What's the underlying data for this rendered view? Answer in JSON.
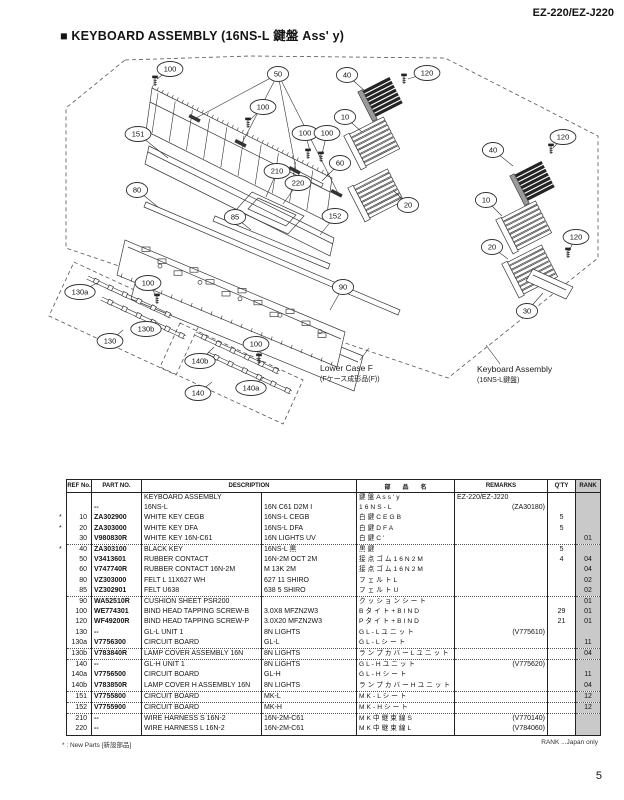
{
  "page": {
    "model": "EZ-220/EZ-J220",
    "title": "■ KEYBOARD ASSEMBLY (16NS-L 鍵盤 Ass' y)",
    "page_number": "5",
    "footnote_left": "* : New Parts [新設部品]",
    "footnote_right": "RANK ...Japan only"
  },
  "diagram": {
    "labels": {
      "lower_case": {
        "en": "Lower Case F",
        "ja": "(Fケース成形品(F))"
      },
      "keyboard_assembly": {
        "en": "Keyboard Assembly",
        "ja": "(16NS-L鍵盤)"
      }
    },
    "callouts": [
      {
        "n": "100",
        "x": 170,
        "y": 69,
        "t": [
          [
            157,
            79
          ]
        ]
      },
      {
        "n": "50",
        "x": 278,
        "y": 74,
        "t": [
          [
            196,
            118
          ],
          [
            242,
            143
          ],
          [
            296,
            170
          ],
          [
            338,
            193
          ]
        ]
      },
      {
        "n": "100",
        "x": 263,
        "y": 107,
        "t": [
          [
            250,
            120
          ]
        ]
      },
      {
        "n": "151",
        "x": 138,
        "y": 134,
        "t": [
          [
            168,
            158
          ]
        ]
      },
      {
        "n": "100",
        "x": 305,
        "y": 133,
        "t": [
          [
            310,
            151
          ]
        ]
      },
      {
        "n": "100",
        "x": 327,
        "y": 133,
        "t": [
          [
            322,
            154
          ]
        ]
      },
      {
        "n": "40",
        "x": 347,
        "y": 75,
        "t": [
          [
            366,
            92
          ]
        ]
      },
      {
        "n": "120",
        "x": 427,
        "y": 73,
        "t": [
          [
            408,
            79
          ]
        ]
      },
      {
        "n": "10",
        "x": 345,
        "y": 117,
        "t": [
          [
            362,
            132
          ]
        ]
      },
      {
        "n": "60",
        "x": 340,
        "y": 163,
        "t": [
          [
            322,
            181
          ]
        ]
      },
      {
        "n": "210",
        "x": 277,
        "y": 171,
        "t": [
          [
            266,
            197
          ]
        ]
      },
      {
        "n": "220",
        "x": 298,
        "y": 183,
        "t": [
          [
            283,
            204
          ]
        ]
      },
      {
        "n": "80",
        "x": 137,
        "y": 190,
        "t": [
          [
            158,
            207
          ]
        ]
      },
      {
        "n": "85",
        "x": 235,
        "y": 217,
        "t": [
          [
            251,
            230
          ]
        ]
      },
      {
        "n": "152",
        "x": 335,
        "y": 216,
        "t": [
          [
            320,
            235
          ]
        ]
      },
      {
        "n": "40",
        "x": 493,
        "y": 150,
        "t": [
          [
            513,
            166
          ]
        ]
      },
      {
        "n": "120",
        "x": 563,
        "y": 137,
        "t": [
          [
            553,
            148
          ]
        ]
      },
      {
        "n": "20",
        "x": 408,
        "y": 205,
        "t": [
          [
            394,
            191
          ]
        ]
      },
      {
        "n": "10",
        "x": 486,
        "y": 200,
        "t": [
          [
            502,
            216
          ]
        ]
      },
      {
        "n": "20",
        "x": 492,
        "y": 247,
        "t": [
          [
            508,
            259
          ]
        ]
      },
      {
        "n": "120",
        "x": 576,
        "y": 237,
        "t": [
          [
            569,
            251
          ]
        ]
      },
      {
        "n": "30",
        "x": 527,
        "y": 311,
        "t": [
          [
            543,
            293
          ]
        ]
      },
      {
        "n": "90",
        "x": 343,
        "y": 287,
        "t": [
          [
            330,
            310
          ]
        ]
      },
      {
        "n": "130a",
        "x": 80,
        "y": 292,
        "t": [
          [
            97,
            283
          ]
        ]
      },
      {
        "n": "100",
        "x": 148,
        "y": 283,
        "t": [
          [
            157,
            297
          ]
        ]
      },
      {
        "n": "130b",
        "x": 146,
        "y": 329,
        "t": [
          [
            152,
            320
          ]
        ]
      },
      {
        "n": "130",
        "x": 110,
        "y": 341,
        "t": [
          [
            123,
            330
          ]
        ]
      },
      {
        "n": "140b",
        "x": 200,
        "y": 361,
        "t": [
          [
            214,
            347
          ]
        ]
      },
      {
        "n": "100",
        "x": 256,
        "y": 344,
        "t": [
          [
            259,
            357
          ]
        ]
      },
      {
        "n": "140a",
        "x": 251,
        "y": 388,
        "t": [
          [
            264,
            377
          ]
        ]
      },
      {
        "n": "140",
        "x": 198,
        "y": 393,
        "t": [
          [
            212,
            382
          ]
        ]
      }
    ]
  },
  "table": {
    "headers": {
      "ref": "REF No.",
      "part": "PART NO.",
      "desc": "DESCRIPTION",
      "name": "部　　品　　名",
      "remarks": "REMARKS",
      "qty": "Q'TY",
      "rank": "RANK"
    },
    "rows": [
      {
        "star": "",
        "ref": "",
        "part": "",
        "desc": "KEYBOARD ASSEMBLY",
        "spec": "",
        "name": "鍵 盤 A s s ' y",
        "remarks": "EZ-220/EZ-J220",
        "qty": "",
        "rank": "",
        "dotted": false
      },
      {
        "star": "",
        "ref": "",
        "part": "--",
        "desc": "16NS-L",
        "spec": "16N C61 D2M I",
        "name": "1 6 N S - L",
        "remarks": "(ZA30180)",
        "qty": "",
        "rank": "",
        "dotted": false
      },
      {
        "star": "*",
        "ref": "10",
        "part": "ZA302900",
        "desc": "WHITE KEY CEGB",
        "spec": "16NS-L CEGB",
        "name": "白 鍵 C E G B",
        "remarks": "",
        "qty": "5",
        "rank": "",
        "dotted": false
      },
      {
        "star": "*",
        "ref": "20",
        "part": "ZA303000",
        "desc": "WHITE KEY DFA",
        "spec": "16NS-L DFA",
        "name": "白 鍵 D F A",
        "remarks": "",
        "qty": "5",
        "rank": "",
        "dotted": false
      },
      {
        "star": "",
        "ref": "30",
        "part": "V980830R",
        "desc": "WHITE KEY 16N-C61",
        "spec": "16N LIGHTS UV",
        "name": "白 鍵 C '",
        "remarks": "",
        "qty": "",
        "rank": "01",
        "dotted": true
      },
      {
        "star": "*",
        "ref": "40",
        "part": "ZA303100",
        "desc": "BLACK KEY",
        "spec": "16NS-L 黒",
        "name": "黒 鍵",
        "remarks": "",
        "qty": "5",
        "rank": "",
        "dotted": false
      },
      {
        "star": "",
        "ref": "50",
        "part": "V3413601",
        "desc": "RUBBER CONTACT",
        "spec": "16N-2M OCT 2M",
        "name": "接 点 ゴ ム 1 6 N 2 M",
        "remarks": "",
        "qty": "4",
        "rank": "04",
        "dotted": false
      },
      {
        "star": "",
        "ref": "60",
        "part": "V747740R",
        "desc": "RUBBER CONTACT 16N-2M",
        "spec": "M 13K 2M",
        "name": "接 点 ゴ ム 1 6 N 2 M",
        "remarks": "",
        "qty": "",
        "rank": "04",
        "dotted": false
      },
      {
        "star": "",
        "ref": "80",
        "part": "VZ303000",
        "desc": "FELT L 11X627 WH",
        "spec": "627 11 SHIRO",
        "name": "フ ェ ル ト L",
        "remarks": "",
        "qty": "",
        "rank": "02",
        "dotted": false
      },
      {
        "star": "",
        "ref": "85",
        "part": "VZ302901",
        "desc": "FELT U638",
        "spec": "638 5 SHIRO",
        "name": "フ ェ ル ト U",
        "remarks": "",
        "qty": "",
        "rank": "02",
        "dotted": true
      },
      {
        "star": "",
        "ref": "90",
        "part": "WA52510R",
        "desc": "CUSHION SHEET PSR200",
        "spec": "",
        "name": "ク ッ シ ョ ン シ ー ト",
        "remarks": "",
        "qty": "",
        "rank": "01",
        "dotted": false
      },
      {
        "star": "",
        "ref": "100",
        "part": "WE774301",
        "desc": "BIND HEAD TAPPING SCREW-B",
        "spec": "3.0X8 MFZN2W3",
        "name": "B タ イ ト + B I N D",
        "remarks": "",
        "qty": "29",
        "rank": "01",
        "dotted": false
      },
      {
        "star": "",
        "ref": "120",
        "part": "WF49200R",
        "desc": "BIND HEAD TAPPING SCREW-P",
        "spec": "3.0X20 MFZN2W3",
        "name": "P タ イ ト + B I N D",
        "remarks": "",
        "qty": "21",
        "rank": "01",
        "dotted": false
      },
      {
        "star": "",
        "ref": "130",
        "part": "--",
        "desc": "GL-L UNIT 1",
        "spec": "8N LIGHTS",
        "name": "G L - L ユ ニ ッ ト",
        "remarks": "(V775610)",
        "qty": "",
        "rank": "",
        "dotted": false
      },
      {
        "star": "",
        "ref": "130a",
        "part": "V7756300",
        "desc": "CIRCUIT BOARD",
        "spec": "GL-L",
        "name": "G L - L シ ー ト",
        "remarks": "",
        "qty": "",
        "rank": "11",
        "dotted": true
      },
      {
        "star": "",
        "ref": "130b",
        "part": "V783840R",
        "desc": "LAMP COVER ASSEMBLY 16N",
        "spec": "8N LIGHTS",
        "name": "ラ ン プ カ バ ー L ユ ニ ッ ト",
        "remarks": "",
        "qty": "",
        "rank": "04",
        "dotted": true
      },
      {
        "star": "",
        "ref": "140",
        "part": "--",
        "desc": "GL-H UNIT 1",
        "spec": "8N LIGHTS",
        "name": "G L - H ユ ニ ッ ト",
        "remarks": "(V775620)",
        "qty": "",
        "rank": "",
        "dotted": false
      },
      {
        "star": "",
        "ref": "140a",
        "part": "V7756500",
        "desc": "CIRCUIT BOARD",
        "spec": "GL-H",
        "name": "G L - H シ ー ト",
        "remarks": "",
        "qty": "",
        "rank": "11",
        "dotted": false
      },
      {
        "star": "",
        "ref": "140b",
        "part": "V783850R",
        "desc": "LAMP COVER H ASSEMBLY 16N",
        "spec": "8N LIGHTS",
        "name": "ラ ン プ カ バ ー H ユ ニ ッ ト",
        "remarks": "",
        "qty": "",
        "rank": "04",
        "dotted": true
      },
      {
        "star": "",
        "ref": "151",
        "part": "V7755800",
        "desc": "CIRCUIT BOARD",
        "spec": "MK-L",
        "name": "M K - L シ ー ト",
        "remarks": "",
        "qty": "",
        "rank": "12",
        "dotted": true
      },
      {
        "star": "",
        "ref": "152",
        "part": "V7755900",
        "desc": "CIRCUIT BOARD",
        "spec": "MK-H",
        "name": "M K - H シ ー ト",
        "remarks": "",
        "qty": "",
        "rank": "12",
        "dotted": true
      },
      {
        "star": "",
        "ref": "210",
        "part": "--",
        "desc": "WIRE HARNESS S 16N-2",
        "spec": "16N-2M-C61",
        "name": "M K 中 継 束 線 S",
        "remarks": "(V770140)",
        "qty": "",
        "rank": "",
        "dotted": false
      },
      {
        "star": "",
        "ref": "220",
        "part": "--",
        "desc": "WIRE HARNESS L 16N-2",
        "spec": "16N-2M-C61",
        "name": "M K 中 継 束 線 L",
        "remarks": "(V784060)",
        "qty": "",
        "rank": "",
        "dotted": false
      }
    ]
  }
}
